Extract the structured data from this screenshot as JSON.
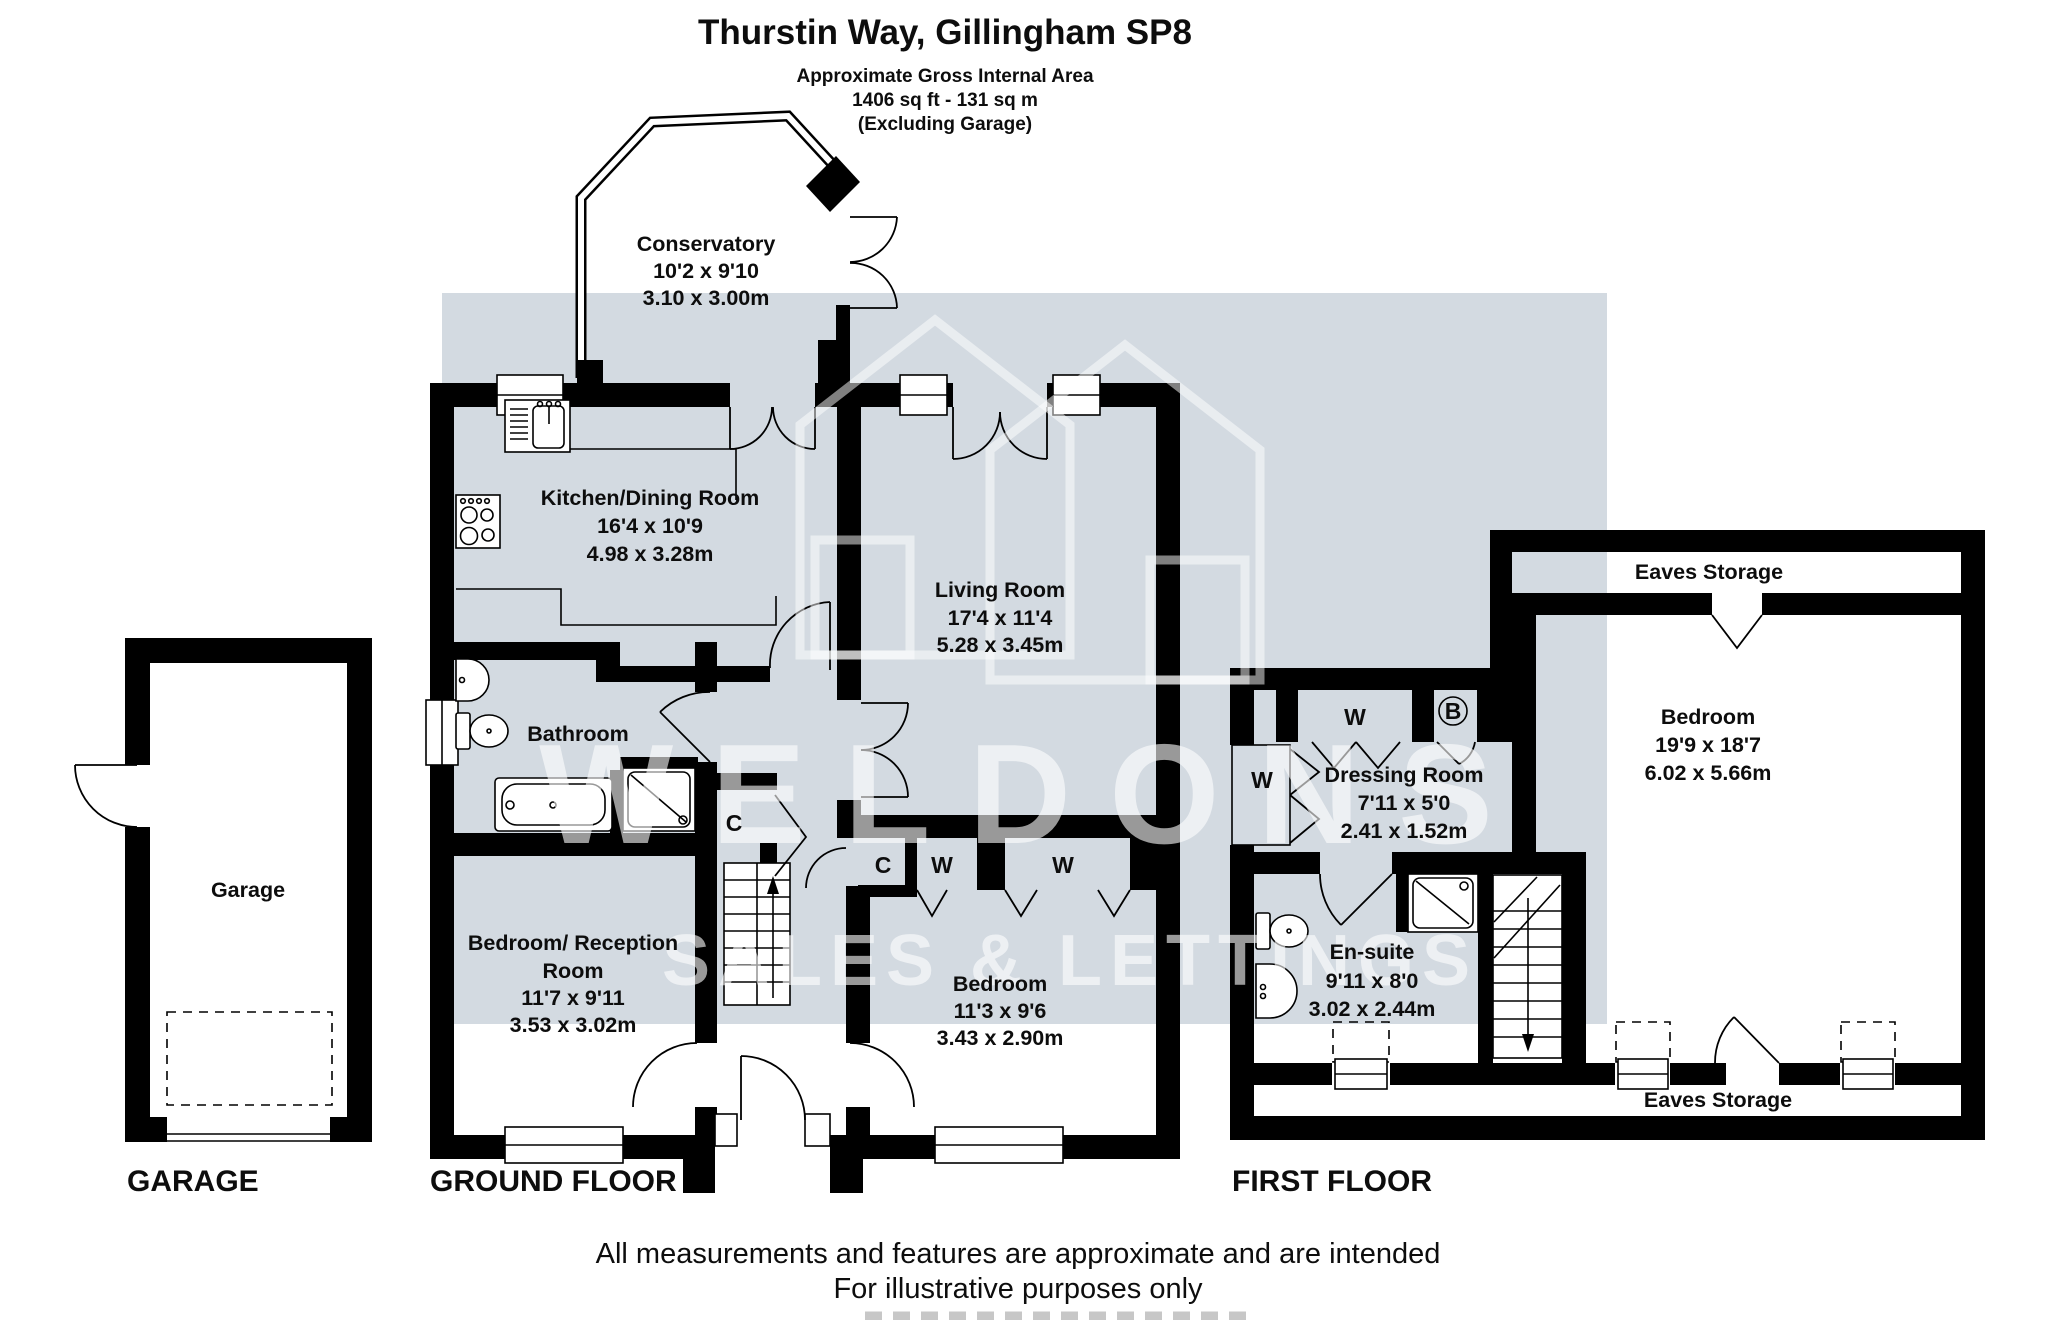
{
  "header": {
    "title": "Thurstin Way, Gillingham SP8",
    "line1": "Approximate Gross Internal Area",
    "line2": "1406 sq ft - 131 sq m",
    "line3": "(Excluding Garage)"
  },
  "watermark": {
    "brand": "WELDONS",
    "tagline": "SALES & LETTINGS"
  },
  "garage": {
    "room_label": "Garage",
    "floor_label": "GARAGE"
  },
  "ground_floor": {
    "floor_label": "GROUND FLOOR",
    "conservatory": {
      "name": "Conservatory",
      "imperial": "10'2 x 9'10",
      "metric": "3.10 x 3.00m"
    },
    "kitchen": {
      "name": "Kitchen/Dining Room",
      "imperial": "16'4 x 10'9",
      "metric": "4.98 x 3.28m"
    },
    "living_room": {
      "name": "Living Room",
      "imperial": "17'4 x 11'4",
      "metric": "5.28 x 3.45m"
    },
    "bathroom": {
      "name": "Bathroom"
    },
    "bedroom_reception": {
      "line1": "Bedroom/ Reception",
      "line2": "Room",
      "imperial": "11'7 x 9'11",
      "metric": "3.53 x 3.02m"
    },
    "bedroom": {
      "name": "Bedroom",
      "imperial": "11'3 x 9'6",
      "metric": "3.43 x 2.90m"
    },
    "closets": {
      "c_hall": "C",
      "c_bedroom": "C",
      "w1": "W",
      "w2": "W"
    }
  },
  "first_floor": {
    "floor_label": "FIRST FLOOR",
    "eaves_top": "Eaves Storage",
    "eaves_bottom": "Eaves Storage",
    "dressing_room": {
      "name": "Dressing Room",
      "imperial": "7'11 x 5'0",
      "metric": "2.41 x 1.52m"
    },
    "ensuite": {
      "name": "En-suite",
      "imperial": "9'11 x 8'0",
      "metric": "3.02 x 2.44m"
    },
    "bedroom": {
      "name": "Bedroom",
      "imperial": "19'9 x 18'7",
      "metric": "6.02 x 5.66m"
    },
    "closets": {
      "w_top": "W",
      "w_left": "W",
      "boiler": "B"
    }
  },
  "footer": {
    "line1": "All measurements and features are approximate and are intended",
    "line2": "For illustrative purposes only"
  },
  "colors": {
    "wall": "#000000",
    "watermark_band": "#d3dae1",
    "fixture_fill": "#ffffff"
  }
}
